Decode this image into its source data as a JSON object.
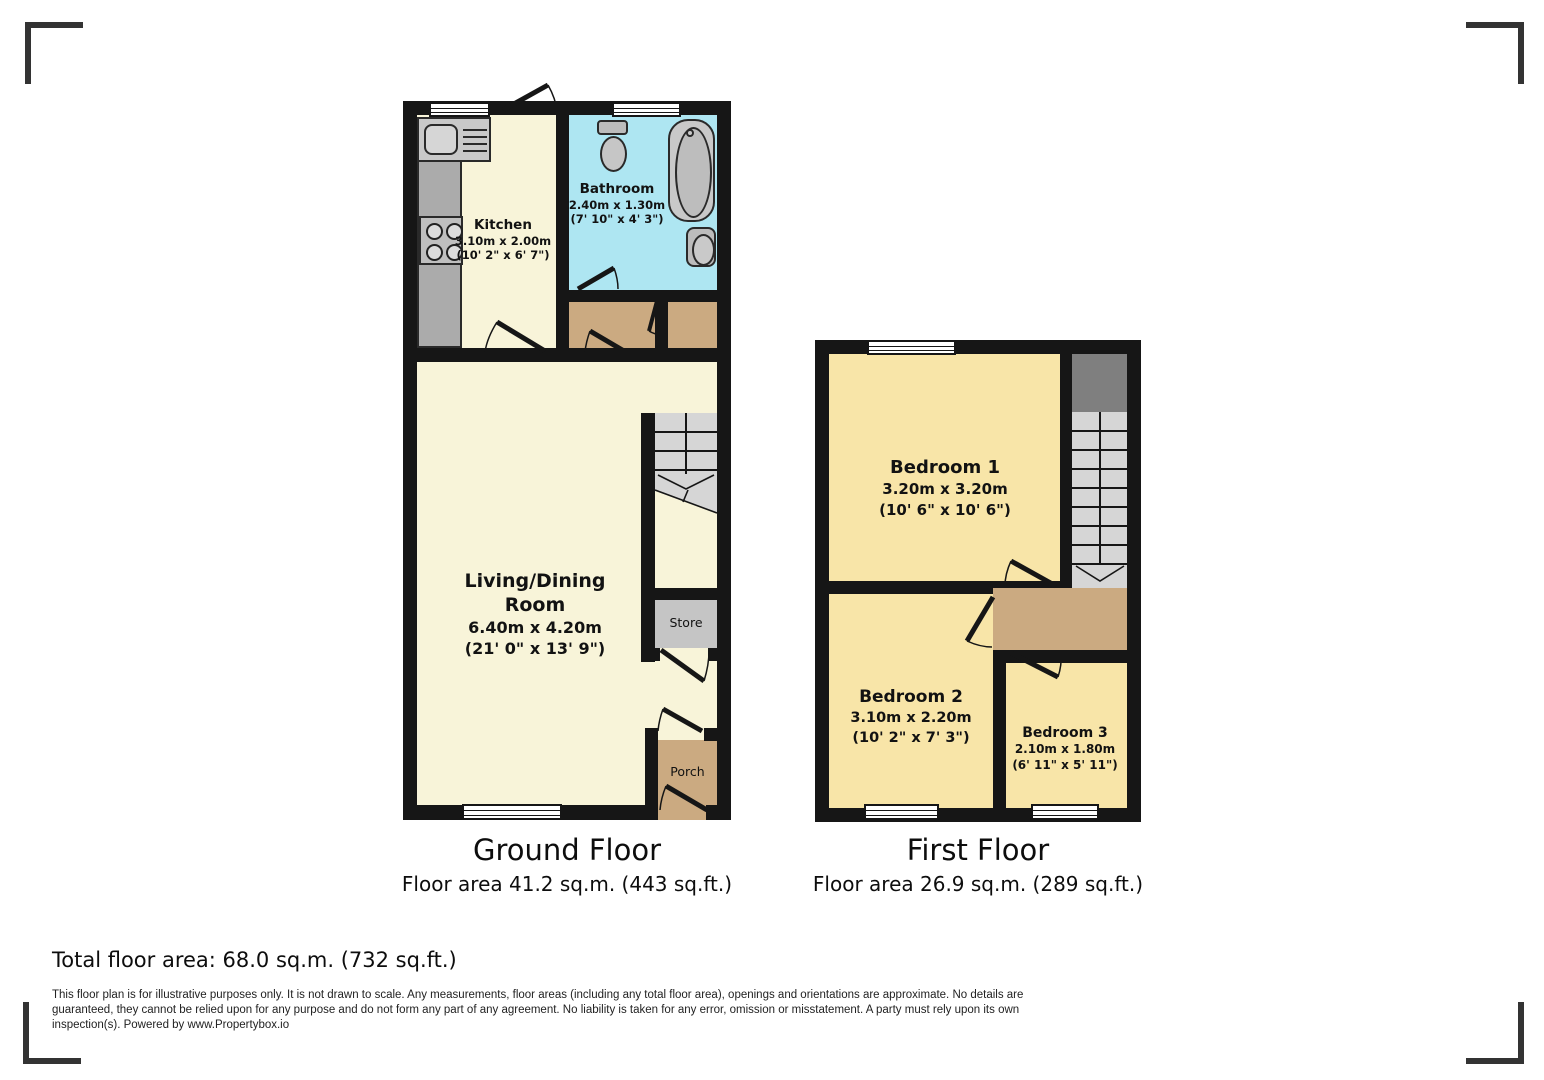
{
  "floors": {
    "ground": {
      "title": "Ground Floor",
      "area_label": "Floor area 41.2 sq.m. (443 sq.ft.)",
      "kitchen": {
        "name": "Kitchen",
        "metric": "3.10m x 2.00m",
        "imperial": "(10' 2\" x 6' 7\")"
      },
      "bathroom": {
        "name": "Bathroom",
        "metric": "2.40m x 1.30m",
        "imperial": "(7' 10\" x 4' 3\")"
      },
      "living": {
        "name": "Living/Dining Room",
        "metric": "6.40m x 4.20m",
        "imperial": "(21' 0\" x 13' 9\")"
      },
      "store": {
        "name": "Store"
      },
      "porch": {
        "name": "Porch"
      }
    },
    "first": {
      "title": "First Floor",
      "area_label": "Floor area 26.9 sq.m. (289 sq.ft.)",
      "bedroom1": {
        "name": "Bedroom 1",
        "metric": "3.20m x 3.20m",
        "imperial": "(10' 6\" x 10' 6\")"
      },
      "bedroom2": {
        "name": "Bedroom 2",
        "metric": "3.10m x 2.20m",
        "imperial": "(10' 2\" x 7' 3\")"
      },
      "bedroom3": {
        "name": "Bedroom 3",
        "metric": "2.10m x 1.80m",
        "imperial": "(6' 11\" x 5' 11\")"
      }
    }
  },
  "footer": {
    "total_area": "Total floor area: 68.0 sq.m. (732 sq.ft.)",
    "disclaimer": "This floor plan is for illustrative purposes only. It is not drawn to scale. Any measurements, floor areas (including any total floor area), openings and orientations are approximate. No details are guaranteed, they cannot be relied upon for any purpose and do not form any part of any agreement. No liability is taken for any error, omission or misstatement. A party must rely upon its own inspection(s). Powered by www.Propertybox.io"
  },
  "colors": {
    "wall": "#161616",
    "ground_room": "#f8f4d9",
    "bedroom": "#f8e5a8",
    "bathroom": "#aee6f2",
    "hall_tan": "#cbaa81",
    "stairs_light": "#d6d6d6",
    "stairs_dark": "#7f7f7f",
    "store_grey": "#c5c5c5"
  }
}
